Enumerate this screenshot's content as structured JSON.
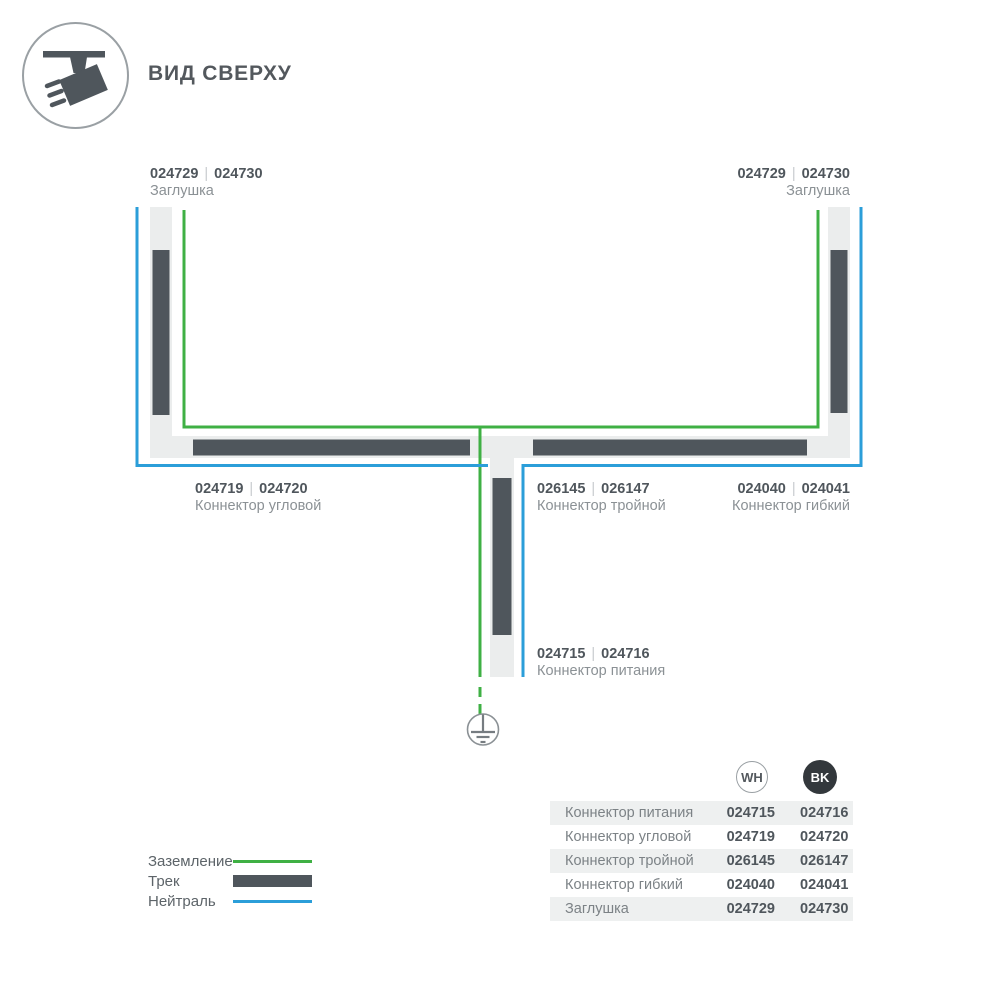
{
  "header": {
    "title": "ВИД СВЕРХУ",
    "icon": "ceiling-track-spotlight"
  },
  "colors": {
    "track_dark": "#4f565c",
    "track_band": "#ebeded",
    "ground_green": "#3fb044",
    "neutral_blue": "#2b9ed9",
    "code_text": "#4f565c",
    "name_text": "#8b9195",
    "table_row_bg": "#eef0f0",
    "bk_circle_bg": "#33383c"
  },
  "codes_separator": "|",
  "diagram": {
    "labels": [
      {
        "id": "endcap-left",
        "codes": [
          "024729",
          "024730"
        ],
        "name": "Заглушка"
      },
      {
        "id": "endcap-right",
        "codes": [
          "024729",
          "024730"
        ],
        "name": "Заглушка"
      },
      {
        "id": "corner",
        "codes": [
          "024719",
          "024720"
        ],
        "name": "Коннектор угловой"
      },
      {
        "id": "triple",
        "codes": [
          "026145",
          "026147"
        ],
        "name": "Коннектор тройной"
      },
      {
        "id": "flex",
        "codes": [
          "024040",
          "024041"
        ],
        "name": "Коннектор гибкий"
      },
      {
        "id": "power",
        "codes": [
          "024715",
          "024716"
        ],
        "name": "Коннектор питания"
      }
    ],
    "ground_symbol": "earth-ground"
  },
  "legend": {
    "items": [
      {
        "label": "Заземление",
        "symbol": "green-line"
      },
      {
        "label": "Трек",
        "symbol": "track-bar"
      },
      {
        "label": "Нейтраль",
        "symbol": "blue-line"
      }
    ]
  },
  "table": {
    "columns": [
      {
        "label": "WH"
      },
      {
        "label": "BK"
      }
    ],
    "rows": [
      {
        "label": "Коннектор питания",
        "wh": "024715",
        "bk": "024716"
      },
      {
        "label": "Коннектор угловой",
        "wh": "024719",
        "bk": "024720"
      },
      {
        "label": "Коннектор тройной",
        "wh": "026145",
        "bk": "026147"
      },
      {
        "label": "Коннектор гибкий",
        "wh": "024040",
        "bk": "024041"
      },
      {
        "label": "Заглушка",
        "wh": "024729",
        "bk": "024730"
      }
    ]
  }
}
